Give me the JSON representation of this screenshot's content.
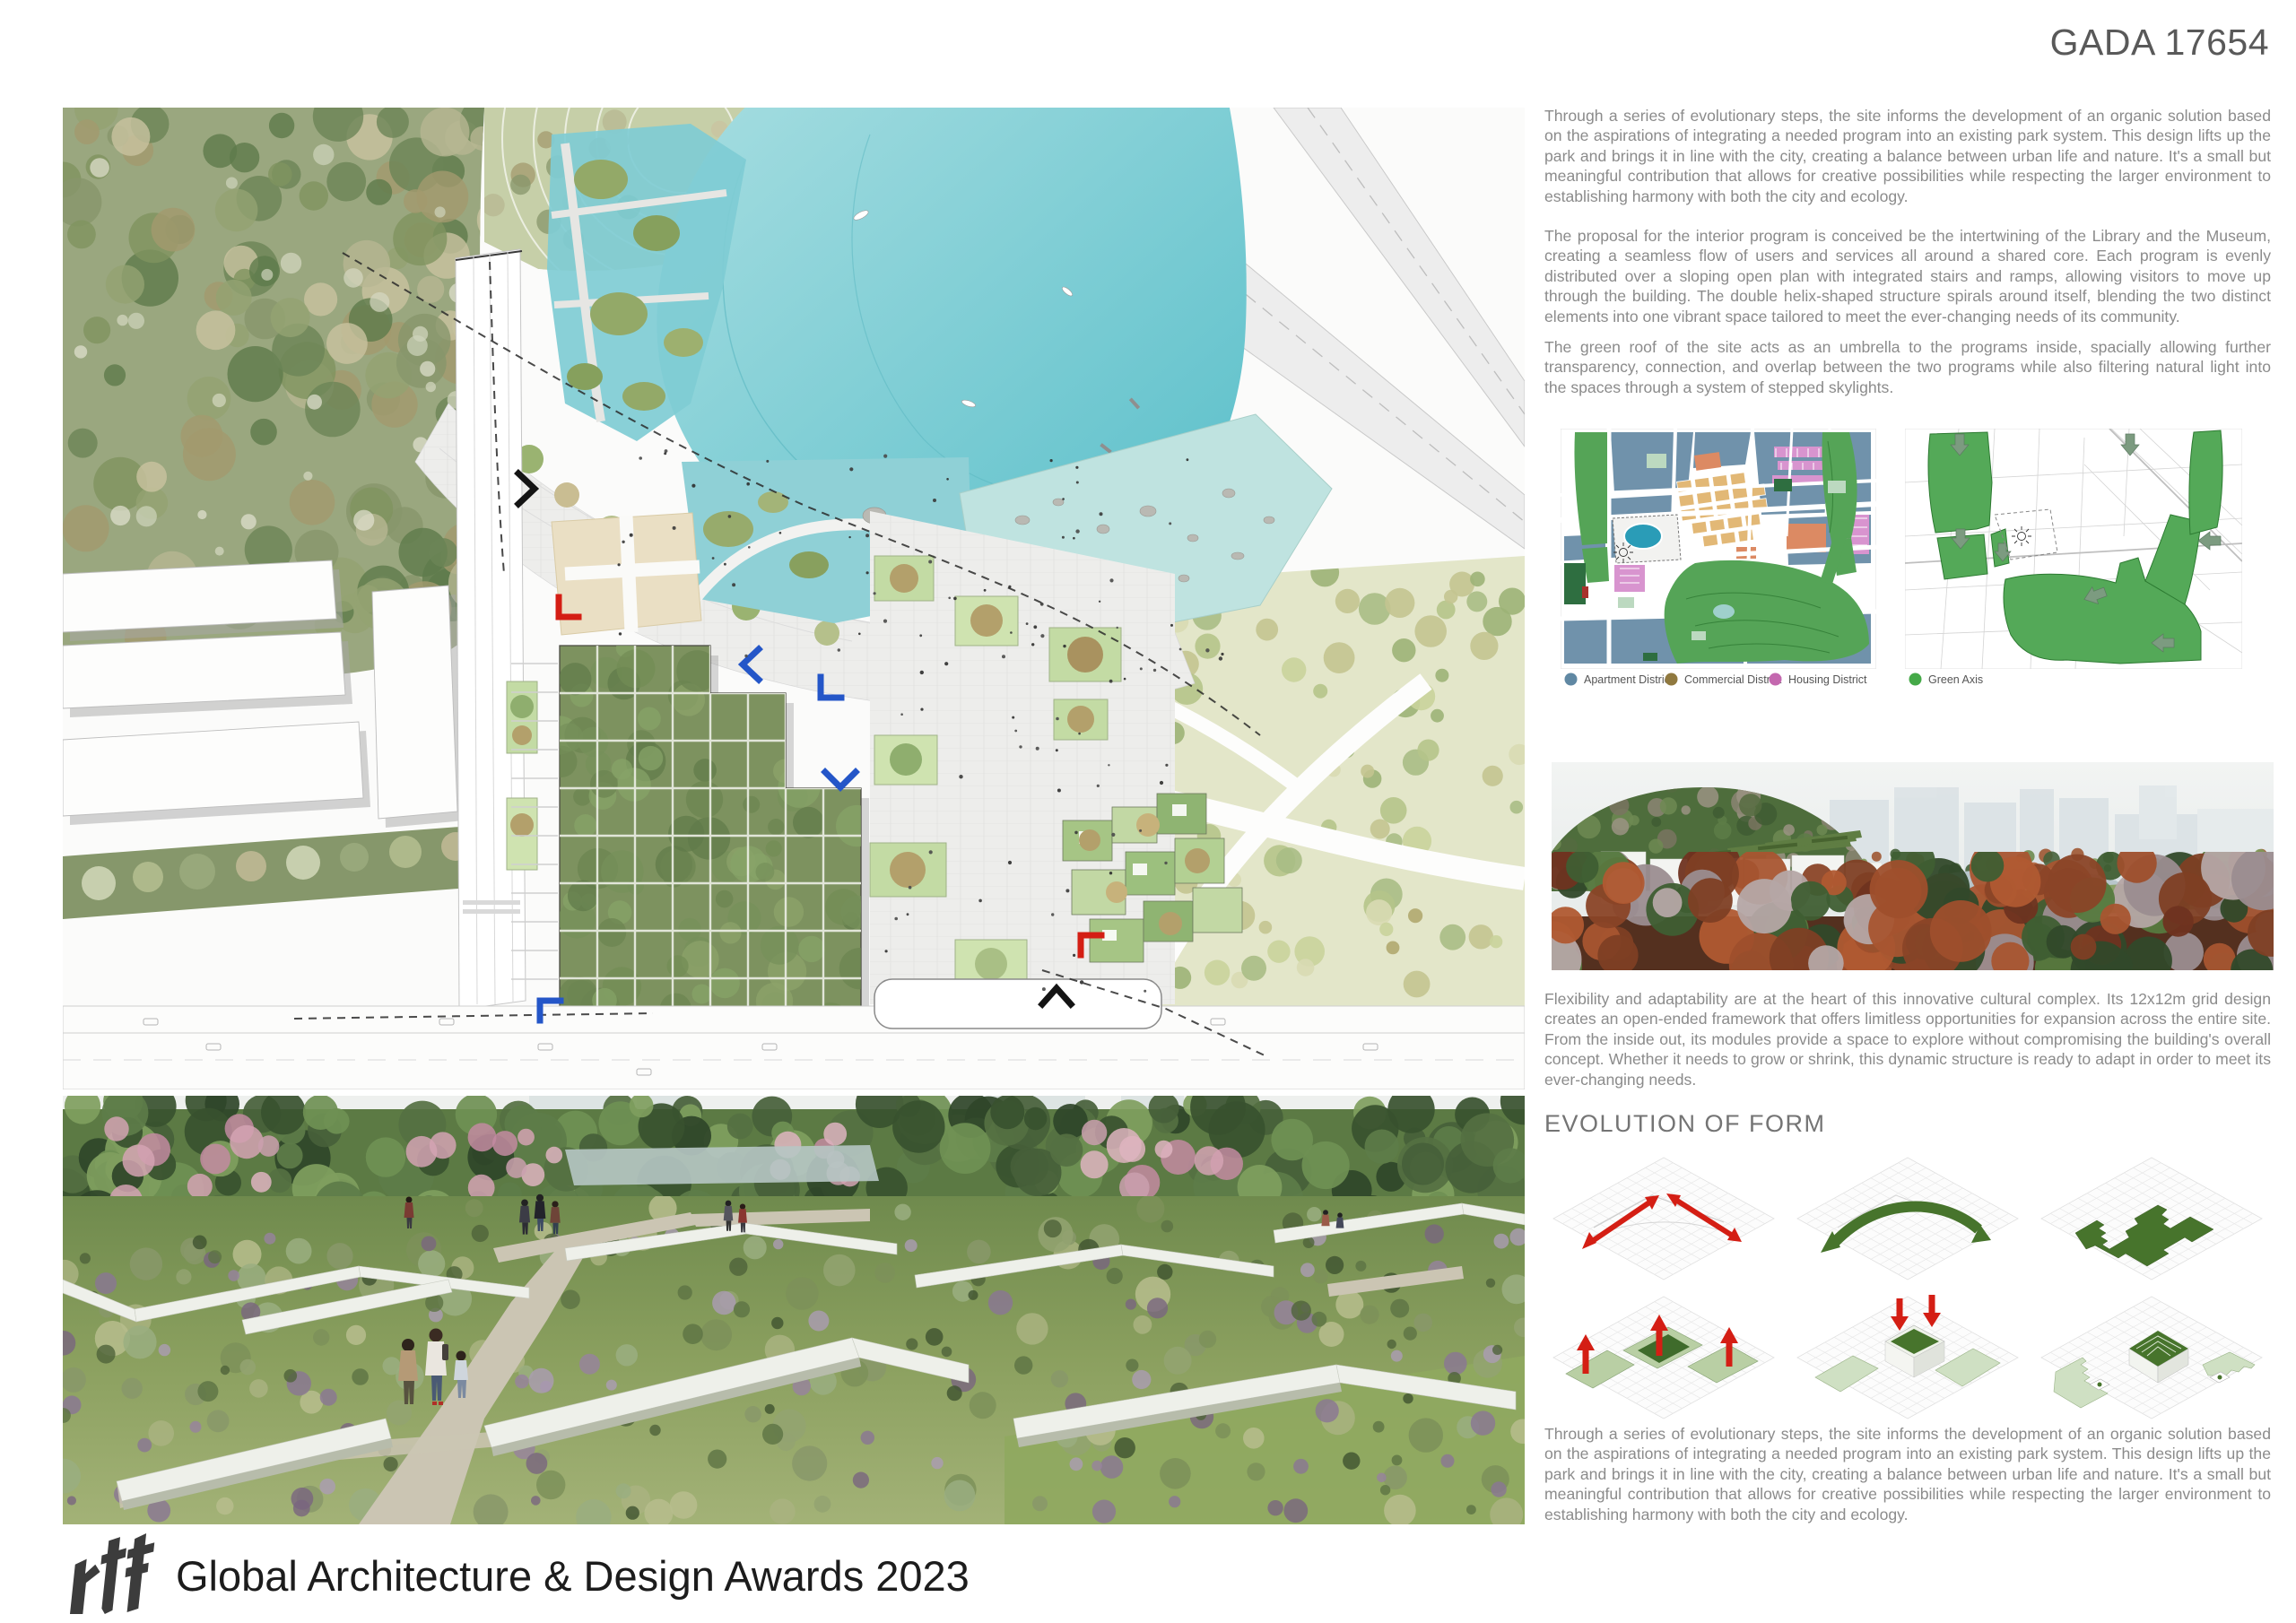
{
  "board": {
    "code": "GADA 17654"
  },
  "texts": {
    "intro": "Through a series of evolutionary steps, the site informs the development of an organic solution based on the aspirations of integrating a needed program into an existing park system. This design lifts up the park and brings it in line with the city, creating a balance between urban life and nature. It's a small but meaningful contribution that allows for creative possibilities while respecting the larger environment to establishing harmony with both the city and ecology.",
    "program": "The proposal for the interior program is conceived be the intertwining of the Library and the Museum, creating a seamless flow of users and services all around a shared core. Each program is evenly distributed over a sloping open plan with integrated stairs and ramps, allowing visitors to move up through the building. The double helix-shaped structure spirals around itself, blending the two distinct elements into one vibrant space tailored to meet the ever-changing needs of its community.",
    "green_roof": "The green roof of the site acts as an umbrella to the programs inside, spacially allowing further transparency, connection, and overlap between the two programs while also filtering natural light into the spaces through a system of stepped skylights.",
    "flexibility": "Flexibility and adaptability are at the heart of this innovative cultural complex. Its 12x12m grid design creates an open-ended framework that offers limitless opportunities for expansion across the entire site. From the inside out, its modules provide a space to explore without compromising the building's overall concept. Whether it needs to grow or shrink, this dynamic structure is ready to adapt in order to meet its ever-changing needs."
  },
  "maps": {
    "legend": [
      {
        "label": "Apartment District",
        "color": "#6088a3"
      },
      {
        "label": "Commercial District",
        "color": "#90793f"
      },
      {
        "label": "Housing District",
        "color": "#c468af"
      },
      {
        "label": "Green Axis",
        "color": "#45a948"
      }
    ]
  },
  "evolution": {
    "heading": "EVOLUTION OF FORM",
    "steps": [
      "site-axes-arrows",
      "green-flow-arrow",
      "stepped-footprint",
      "lift-roof-plates",
      "press-center-volume",
      "final-stepped-massing"
    ]
  },
  "footer": {
    "logo": "rtf",
    "text": "Global Architecture & Design Awards 2023"
  },
  "colors": {
    "accent_red": "#d41e14",
    "diagram_green": "#47742c",
    "lake_teal": "#57bec9",
    "body_text": "#8b8b8b"
  }
}
